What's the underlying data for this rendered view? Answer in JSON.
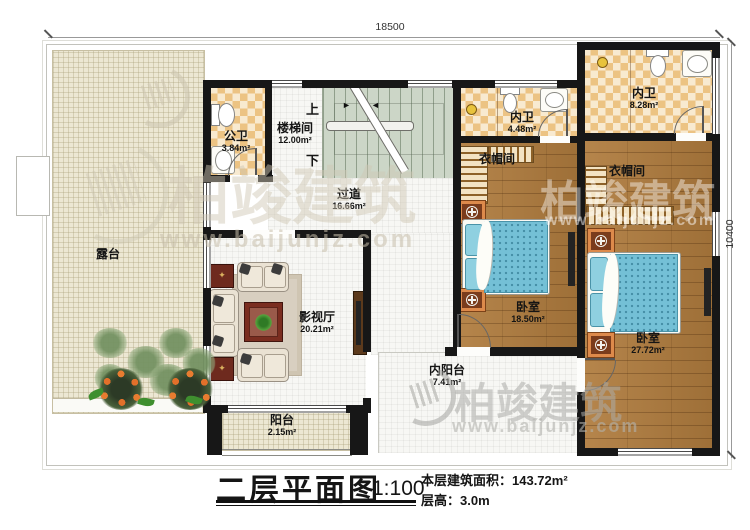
{
  "dimensions": {
    "total_width": "18500",
    "total_height": "10400"
  },
  "rooms": {
    "terrace": {
      "name": "露台"
    },
    "public_bath": {
      "name": "公卫",
      "area": "3.84m²"
    },
    "stairwell": {
      "name": "楼梯间",
      "area": "12.00m²",
      "up": "上",
      "down": "下"
    },
    "corridor": {
      "name": "过道",
      "area": "16.66m²"
    },
    "theater": {
      "name": "影视厅",
      "area": "20.21m²"
    },
    "inner_bath_small": {
      "name": "内卫",
      "area": "4.48m²"
    },
    "inner_bath_large": {
      "name": "内卫",
      "area": "8.28m²"
    },
    "cloakroom_left": {
      "name": "衣帽间"
    },
    "cloakroom_right": {
      "name": "衣帽间"
    },
    "bedroom_left": {
      "name": "卧室",
      "area": "18.50m²"
    },
    "bedroom_right": {
      "name": "卧室",
      "area": "27.72m²"
    },
    "inner_balcony": {
      "name": "内阳台",
      "area": "7.41m²"
    },
    "balcony": {
      "name": "阳台",
      "area": "2.15m²"
    }
  },
  "stair_icons": {
    "arrow_right": "►",
    "arrow_left": "◄"
  },
  "title_block": {
    "title": "二层平面图",
    "scale": "1:100",
    "floor_area": "本层建筑面积：143.72m²",
    "floor_height": "层高：3.0m"
  },
  "watermark": {
    "brand": "柏竣建筑",
    "url": "www.baijunjz.com"
  },
  "colors": {
    "wall": "#171717",
    "tile": "#ecc383",
    "wood": "#b07c3e",
    "bed": "#74c0d6",
    "stairs": "#ccd6c7",
    "terrace": "#ece7d3",
    "flower": "#e2702a"
  }
}
